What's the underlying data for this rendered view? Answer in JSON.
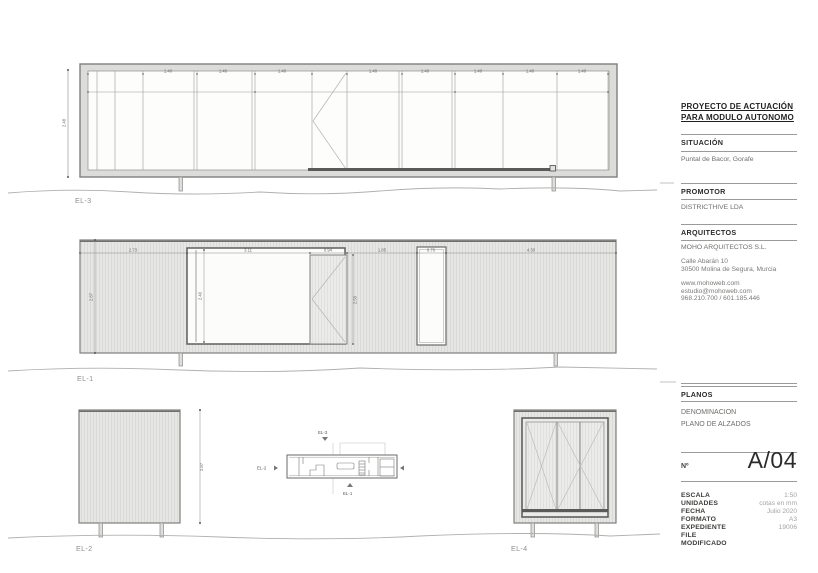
{
  "title_block": {
    "project_line1": "PROYECTO DE ACTUACIÓN",
    "project_line2": "PARA MODULO AUTONOMO",
    "situacion": {
      "heading": "SITUACIÓN",
      "value": "Puntal de Bacor, Gorafe"
    },
    "promotor": {
      "heading": "PROMOTOR",
      "value": "DISTRICTHIVE LDA"
    },
    "arquitectos": {
      "heading": "ARQUITECTOS",
      "name": "MOHO ARQUITECTOS S.L.",
      "address1": "Calle Abarán 10",
      "address2": "30500 Molina de Segura, Murcia",
      "web": "www.mohoweb.com",
      "email": "estudio@mohoweb.com",
      "phone": "968.210.700 / 601.185.446"
    },
    "planos": {
      "heading": "PLANOS",
      "denominacion_label": "DENOMINACION",
      "denominacion_value": "PLANO DE ALZADOS"
    },
    "numero": {
      "label": "Nº",
      "value": "A/04"
    },
    "info_rows": [
      {
        "label": "ESCALA",
        "value": "1:50"
      },
      {
        "label": "UNIDADES",
        "value": "cotas en mm"
      },
      {
        "label": "FECHA",
        "value": "Julio 2020"
      },
      {
        "label": "FORMATO",
        "value": "A3"
      },
      {
        "label": "EXPEDIENTE",
        "value": "19006"
      },
      {
        "label": "FILE",
        "value": ""
      },
      {
        "label": "MODIFICADO",
        "value": ""
      }
    ]
  },
  "drawings": {
    "el3": {
      "label": "EL-3",
      "height_dim": "2.48",
      "panel_dims": [
        "1.40",
        "1.40",
        "1.40",
        "1.40",
        "1.40",
        "1.40",
        "1.40",
        "1.40"
      ]
    },
    "el1": {
      "label": "EL-1",
      "top_dims": [
        "2.73",
        "3.11",
        "0.94",
        "1.85",
        "0.70",
        "4.30"
      ],
      "height_dim": "2.87",
      "opening_height_dim": "2.40",
      "door_height_dim": "2.50"
    },
    "el2": {
      "label": "EL-2",
      "height_dim": "2.87"
    },
    "el4": {
      "label": "EL-4"
    },
    "key_plan": {
      "marker_top": "EL-3",
      "marker_left": "EL-2",
      "marker_bottom": "EL-1"
    }
  },
  "colors": {
    "wall_fill": "#e6e6e4",
    "hatch_line": "#d3d3d1",
    "frame_gray": "#dcdcda",
    "drawing_line": "#8a8a88",
    "dark_track": "#5a5a58",
    "rule": "#9b9b99",
    "heading_text": "#2b2b2b",
    "body_text": "#6e6e6c"
  }
}
